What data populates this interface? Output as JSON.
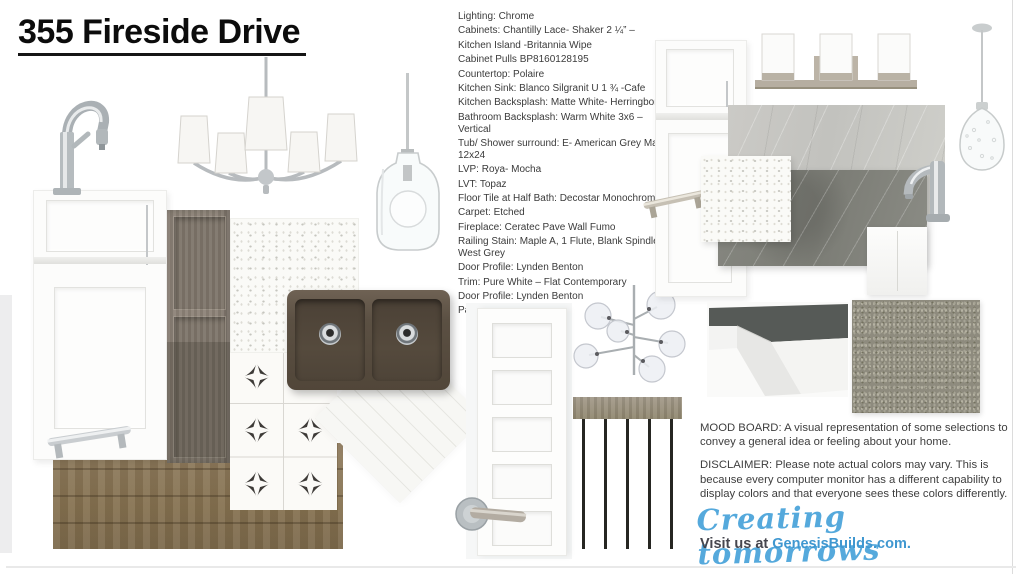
{
  "page": {
    "title": "355 Fireside Drive"
  },
  "specs": [
    "Lighting:  Chrome",
    "Cabinets: Chantilly Lace- Shaker 2 ¼” –",
    " Kitchen Island -Britannia Wipe",
    "Cabinet Pulls BP8160128195",
    "Countertop: Polaire",
    "Kitchen Sink: Blanco Silgranit U 1 ¾ -Cafe",
    "Kitchen Backsplash: Matte White- Herringbone",
    "Bathroom Backsplash: Warm White 3x6 – Vertical",
    "Tub/ Shower surround: E- American Grey Matte 12x24",
    "LVP: Roya- Mocha",
    "LVT: Topaz",
    "Floor Tile at Half Bath: Decostar Monochrome",
    "Carpet: Etched",
    "Fireplace: Ceratec Pave Wall Fumo",
    "Railing Stain: Maple A, 1 Flute, Blank Spindle, West Grey",
    "Door Profile: Lynden Benton",
    "Trim: Pure White – Flat Contemporary",
    "Door Profile: Lynden Benton",
    "Paint: Drift Of Mist"
  ],
  "footer": {
    "mood_board": "MOOD BOARD:  A visual representation of some selections to convey a general idea or feeling about your home.",
    "disclaimer": "DISCLAIMER:  Please note actual colors may vary. This is because every computer monitor has a different capability to display colors and that everyone sees these colors differently.",
    "tagline": "Creating tomorrows",
    "visit_prefix": "Visit us at ",
    "website": "GenesisBuilds.com."
  },
  "colors": {
    "tagline_blue": "#55a9dc",
    "link_blue": "#3f97d0",
    "text_dark": "#3b3b3b",
    "sink_cafe_brown": "#5b5043",
    "wood_lvp": "#84704f"
  },
  "collage_items": [
    "kitchen-faucet",
    "white-base-cabinet",
    "cabinet-bar-pull",
    "gray-wood-cabinet",
    "five-light-chandelier",
    "glass-jar-pendant",
    "quartz-countertop-polaire",
    "star-tile-decostar-monochrome",
    "double-bowl-cafe-sink",
    "herringbone-backsplash",
    "lvp-wood-floor",
    "interior-five-panel-door",
    "door-lever-handle",
    "sputnik-chandelier",
    "stair-railing",
    "white-cabinet-door",
    "vanity-bar-light",
    "light-grey-marble-slab",
    "dark-grey-marble-slab",
    "bathroom-faucet",
    "seeded-glass-pendant",
    "vertical-white-tile",
    "baseboard-trim-sample",
    "carpet-sample-etched"
  ]
}
